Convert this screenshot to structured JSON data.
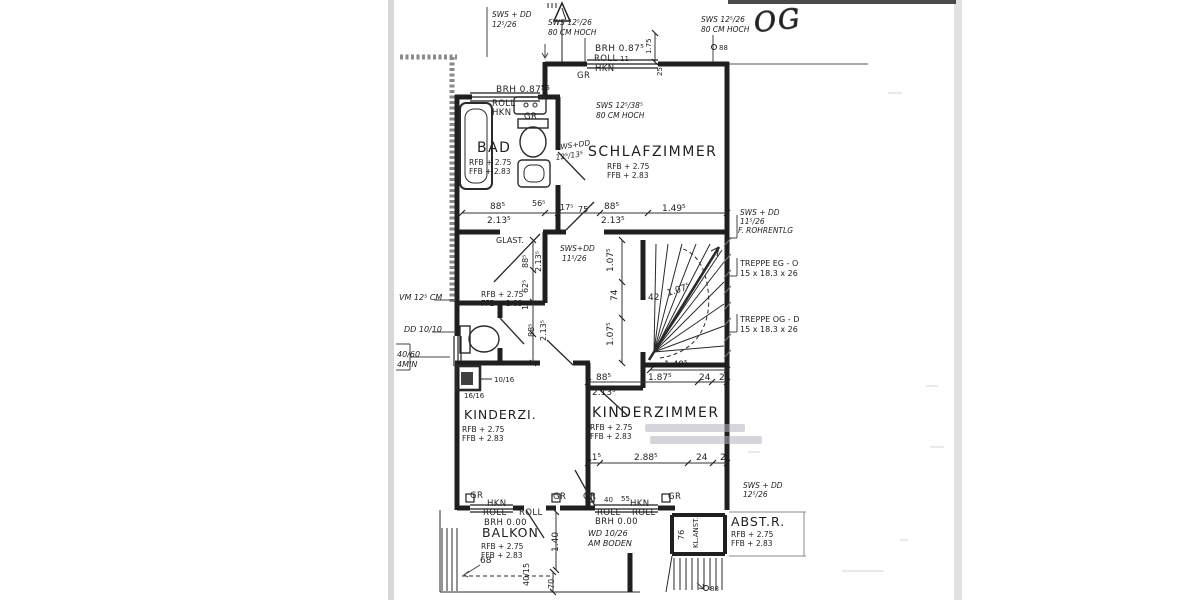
{
  "colors": {
    "ink": "#1f1f1f",
    "paper": "#ffffff",
    "scan_edge": "#d8d8d8",
    "watermark": "#b4b4bf"
  },
  "notes": {
    "top_left_1": "SWS + DD",
    "top_left_2": "12⁵/26",
    "win_a_1": "SWS 12⁵/26",
    "win_a_2": "80 CM HOCH",
    "win_b_1": "SWS 12⁵/26",
    "win_b_2": "80 CM HOCH",
    "floor_mark": "OG",
    "phi_top": "88",
    "phi_bottom": "88"
  },
  "win_bad": {
    "brh": "BRH 0.87⁵",
    "h55": "55",
    "roll": "ROLL",
    "hkn": "HKN",
    "gr": "GR"
  },
  "win_schlaf": {
    "brh": "BRH 0.87⁵",
    "roll": "ROLL",
    "hkn": "HKN",
    "gr": "GR",
    "n11": "11",
    "v175": "1.75",
    "v25": "25"
  },
  "schlaf_notes": {
    "win_1": "SWS 12⁵/38⁵",
    "win_2": "80 CM HOCH",
    "diag_1": "SWS+DD",
    "diag_2": "12⁵/13⁵"
  },
  "rooms": {
    "bad": {
      "name": "BAD",
      "rfb": "RFB + 2.75",
      "ffb": "FFB + 2.83"
    },
    "schlafzimmer": {
      "name": "SCHLAFZIMMER",
      "rfb": "RFB + 2.75",
      "ffb": "FFB + 2.83"
    },
    "kinderzi": {
      "name": "KINDERZI.",
      "rfb": "RFB + 2.75",
      "ffb": "FFB + 2.83"
    },
    "kinderzimmer": {
      "name": "KINDERZIMMER",
      "rfb": "RFB + 2.75",
      "ffb": "FFB + 2.83"
    },
    "balkon": {
      "name": "BALKON",
      "rfb": "RFB + 2.75",
      "ffb": "FFB + 2.83"
    },
    "abstr": {
      "name": "ABST.R.",
      "rfb": "RFB + 2.75",
      "ffb": "FFB + 2.83"
    },
    "flur": {
      "rfb": "RFB + 2.75",
      "ffb": "FFB + 2.83"
    }
  },
  "flur_notes": {
    "glast": "GLAST.",
    "diag_1": "SWS+DD",
    "diag_2": "11⁵/26"
  },
  "left_margin": {
    "sws_1": "SWS + DD",
    "sws_2": "12⁵/26",
    "vm": "VM 12⁵ CM",
    "dd": "DD 10/10",
    "vent_1": "40/60",
    "vent_2": "4MIN"
  },
  "right_margin": {
    "sws_1": "SWS + DD",
    "sws_2": "11⁵/26",
    "sws_3": "F. ROHRENTLG",
    "treppe1_1": "TREPPE EG - O",
    "treppe1_2": "15 x 18.3 x 26",
    "treppe2_1": "TREPPE OG - D",
    "treppe2_2": "15 x 18.3 x 26",
    "sws_4": "SWS + DD",
    "sws_5": "12⁵/26"
  },
  "wc_labels": {
    "shaft_small": "10/16",
    "shaft_big": "16/16"
  },
  "dims": {
    "top": [
      "88⁵",
      "2.13⁵",
      "56⁵",
      "17⁵",
      "75",
      "88⁵",
      "2.13⁵",
      "1.49⁵"
    ],
    "v_left": [
      "88⁵",
      "2.13⁵",
      "62⁵",
      "15",
      "88⁵",
      "2.13⁵"
    ],
    "v_right": [
      "1.07⁵",
      "74",
      "1.07⁵"
    ],
    "stair": [
      "42",
      "1.07⁵"
    ],
    "mid": [
      "1.49⁵",
      "88⁵",
      "2.13⁵",
      "1.87⁵",
      "24",
      "2"
    ],
    "bottom": [
      "11⁵",
      "2.88⁵",
      "24",
      "2"
    ],
    "balkon": [
      "1.40",
      "68",
      "40/15",
      "70"
    ],
    "klanst": [
      "76",
      "KL.ANST."
    ]
  },
  "band": {
    "gr1": "GR",
    "hkn1": "HKN",
    "roll1": "ROLL",
    "roll2": "ROLL",
    "brh1": "BRH 0.00",
    "gr2": "GR",
    "gr3": "GR",
    "n40": "40",
    "n55": "55",
    "hkn2": "HKN",
    "roll3": "ROLL",
    "roll4": "ROLL",
    "brh2": "BRH 0.00",
    "gr4": "GR",
    "wd_1": "WD 10/26",
    "wd_2": "AM BODEN"
  }
}
